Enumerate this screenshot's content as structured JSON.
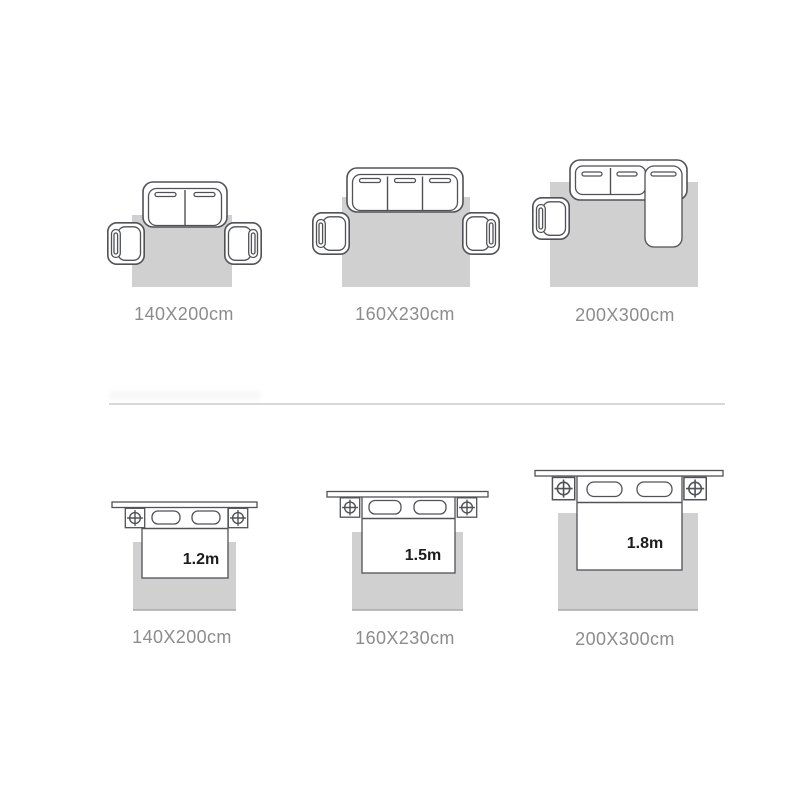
{
  "colors": {
    "background": "#ffffff",
    "rug_fill": "#d0d0d0",
    "furniture_outline": "#505257",
    "size_label_text": "#8c8c8c",
    "bed_width_text": "#1c1c1c",
    "divider": "#d8d8d8"
  },
  "sofa_rug_sizes": {
    "items": [
      {
        "size_label": "140X200cm"
      },
      {
        "size_label": "160X230cm"
      },
      {
        "size_label": "200X300cm"
      }
    ]
  },
  "bed_rug_sizes": {
    "items": [
      {
        "bed_width_label": "1.2m",
        "size_label": "140X200cm"
      },
      {
        "bed_width_label": "1.5m",
        "size_label": "160X230cm"
      },
      {
        "bed_width_label": "1.8m",
        "size_label": "200X300cm"
      }
    ]
  }
}
